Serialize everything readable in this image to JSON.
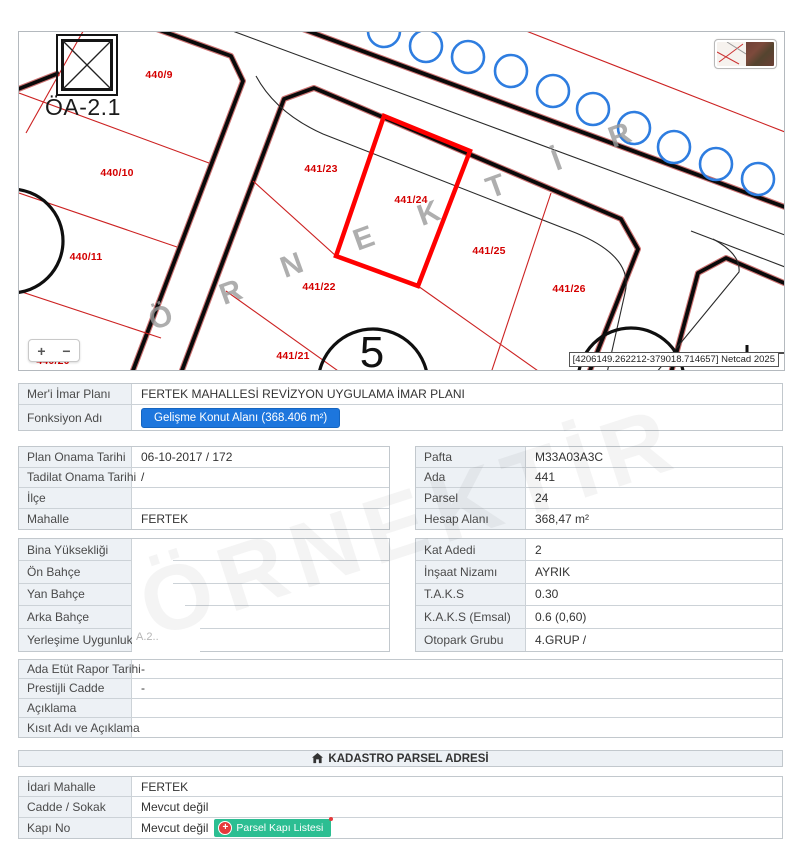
{
  "map": {
    "oa_label": "ÖA-2.1",
    "netcad": "[4206149.262212-379018.714657] Netcad 2025",
    "zoom_plus": "+",
    "zoom_minus": "−",
    "watermark_text": "ÖRNEKTİR",
    "watermark_letters": [
      {
        "ch": "Ö",
        "x": 142,
        "y": 286
      },
      {
        "ch": "R",
        "x": 212,
        "y": 261
      },
      {
        "ch": "N",
        "x": 273,
        "y": 234
      },
      {
        "ch": "E",
        "x": 345,
        "y": 207
      },
      {
        "ch": "K",
        "x": 410,
        "y": 182
      },
      {
        "ch": "T",
        "x": 477,
        "y": 155
      },
      {
        "ch": "İ",
        "x": 538,
        "y": 129
      },
      {
        "ch": "R",
        "x": 601,
        "y": 104
      }
    ],
    "parcel_labels": [
      {
        "text": "440/9",
        "x": 140,
        "y": 43,
        "sel": false
      },
      {
        "text": "440/10",
        "x": 98,
        "y": 141,
        "sel": false
      },
      {
        "text": "440/11",
        "x": 67,
        "y": 225,
        "sel": false
      },
      {
        "text": "441/23",
        "x": 302,
        "y": 137,
        "sel": false
      },
      {
        "text": "441/24",
        "x": 392,
        "y": 168,
        "sel": true
      },
      {
        "text": "441/25",
        "x": 470,
        "y": 219,
        "sel": false
      },
      {
        "text": "441/26",
        "x": 550,
        "y": 257,
        "sel": false
      },
      {
        "text": "441/22",
        "x": 300,
        "y": 255,
        "sel": false
      },
      {
        "text": "441/21",
        "x": 274,
        "y": 324,
        "sel": false
      },
      {
        "text": "440/20",
        "x": 34,
        "y": 329,
        "sel": false
      }
    ],
    "block_numbers": [
      {
        "text": "2",
        "x": -12,
        "y": 212
      },
      {
        "text": "5",
        "x": 353,
        "y": 321
      }
    ]
  },
  "tables": {
    "t1": {
      "rows": [
        {
          "label": "Mer'i İmar Planı",
          "value": "FERTEK MAHALLESİ REVİZYON UYGULAMA İMAR PLANI"
        },
        {
          "label": "Fonksiyon Adı",
          "value": "",
          "button": {
            "style": "primary",
            "text": "Gelişme Konut Alanı (368.406 m²)"
          }
        }
      ]
    },
    "t2l": {
      "rows": [
        {
          "label": "Plan Onama Tarihi",
          "value": "06-10-2017 / 172"
        },
        {
          "label": "Tadilat Onama Tarihi",
          "value": "/"
        },
        {
          "label": "İlçe",
          "value": ""
        },
        {
          "label": "Mahalle",
          "value": "FERTEK"
        }
      ]
    },
    "t2r": {
      "rows": [
        {
          "label": "Pafta",
          "value": "M33A03A3C"
        },
        {
          "label": "Ada",
          "value": "441"
        },
        {
          "label": "Parsel",
          "value": "24"
        },
        {
          "label": "Hesap Alanı",
          "value": "368,47 m²"
        }
      ]
    },
    "t3l": {
      "rows": [
        {
          "label": "Bina Yüksekliği",
          "value": ""
        },
        {
          "label": "Ön Bahçe",
          "value": ""
        },
        {
          "label": "Yan Bahçe",
          "value": ""
        },
        {
          "label": "Arka Bahçe",
          "value": ""
        },
        {
          "label": "Yerleşime Uygunluk",
          "value": ""
        }
      ]
    },
    "t3r": {
      "rows": [
        {
          "label": "Kat Adedi",
          "value": "2"
        },
        {
          "label": "İnşaat Nizamı",
          "value": "AYRIK"
        },
        {
          "label": "T.A.K.S",
          "value": "0.30"
        },
        {
          "label": "K.A.K.S (Emsal)",
          "value": "0.6 (0,60)"
        },
        {
          "label": "Otopark Grubu",
          "value": "4.GRUP /"
        }
      ]
    },
    "t4": {
      "rows": [
        {
          "label": "Ada Etüt Rapor Tarihi",
          "value": "-"
        },
        {
          "label": "Prestijli Cadde",
          "value": "-"
        },
        {
          "label": "Açıklama",
          "value": ""
        },
        {
          "label": "Kısıt Adı ve Açıklama",
          "value": ""
        }
      ]
    },
    "t5": {
      "rows": [
        {
          "label": "İdari Mahalle",
          "value": "FERTEK"
        },
        {
          "label": "Cadde / Sokak",
          "value": "Mevcut değil"
        },
        {
          "label": "Kapı No",
          "value": "Mevcut değil",
          "button": {
            "style": "success",
            "text": "Parsel Kapı Listesi",
            "icon": "plus-circle-icon"
          }
        }
      ]
    }
  },
  "section_header": {
    "title": "KADASTRO PARSEL ADRESİ",
    "icon": "home-icon"
  },
  "redacted_hint": "A.2..",
  "colors": {
    "accent_blue": "#1d76dd",
    "accent_green": "#2cbe92",
    "alert_red": "#e5383b",
    "parcel_red": "#d40000",
    "selected_parcel": "#ff0000",
    "tree_blue": "#2e7de0"
  }
}
